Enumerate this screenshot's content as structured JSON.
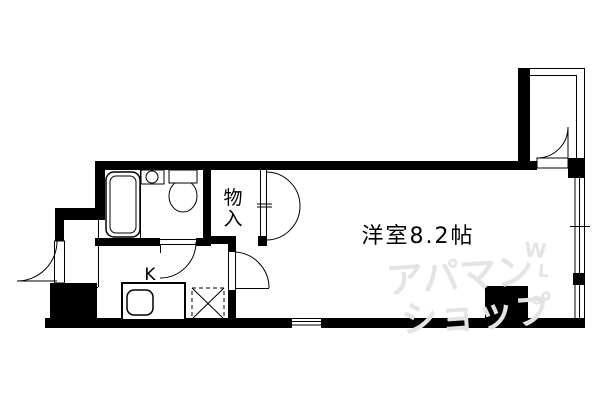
{
  "page": {
    "background_color": "#ffffff",
    "wall_color": "#000000",
    "line_color": "#000000",
    "watermark_color": "#e4e4e4"
  },
  "floor_plan": {
    "rooms": [
      {
        "id": "western-room",
        "label": "洋室8.2帖",
        "type": "洋室",
        "size": "8.2帖"
      },
      {
        "id": "closet",
        "label": "物入",
        "chars": [
          "物",
          "入"
        ]
      },
      {
        "id": "kitchen",
        "label": "K"
      }
    ],
    "fixtures": [
      "bathtub",
      "washbasin",
      "toilet",
      "kitchen-counter",
      "kitchen-sink",
      "refrigerator-space",
      "entrance-door",
      "porch-door",
      "interior-door",
      "kitchen-room-door",
      "closet-double-doors",
      "right-window",
      "bottom-window"
    ]
  },
  "watermark": {
    "line1": "アパマン",
    "line2": "ショップ",
    "side_marks": [
      "W",
      "L",
      "o"
    ]
  }
}
